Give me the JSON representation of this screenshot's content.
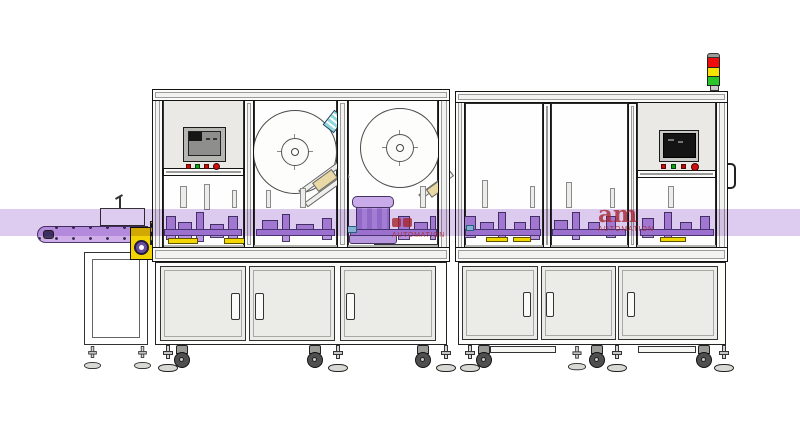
{
  "watermark": {
    "logo": "am",
    "caption": "AUTOMATION",
    "color": "#c03030"
  },
  "colors": {
    "highlight_band": "#decbf0",
    "conveyor_belt": "#cfaeea",
    "machine_part_purple": "#b995e0",
    "rail_purple": "#b28ddc",
    "accent_yellow": "#f2d403",
    "accent_cyan": "#9adde0",
    "tower_red": "#ef0d0b",
    "tower_yellow": "#f6e303",
    "tower_green": "#29c62a",
    "button_red": "#c40f0f",
    "button_green": "#14a014",
    "panel_gray": "#eae9e6",
    "door_gray": "#ebebe8",
    "frame_outline": "#141414",
    "screen_dark": "#141414",
    "screen_gray": "#8e8e8c",
    "tan_block": "#e9d9a5"
  },
  "signal_tower": {
    "segments": [
      "red",
      "yellow",
      "green"
    ]
  },
  "hmi_left": {
    "buttons": [
      "red",
      "green",
      "red",
      "red-round"
    ]
  },
  "hmi_right": {
    "buttons": [
      "red",
      "green",
      "red",
      "red-round"
    ]
  },
  "shapes": [
    {
      "n": "guard-post",
      "c": "post",
      "x": 180,
      "y": 186,
      "w": 7,
      "h": 22
    },
    {
      "n": "guard-post",
      "c": "post",
      "x": 204,
      "y": 184,
      "w": 6,
      "h": 26
    },
    {
      "n": "guard-post",
      "c": "post",
      "x": 232,
      "y": 190,
      "w": 5,
      "h": 18
    },
    {
      "n": "guard-post",
      "c": "post",
      "x": 266,
      "y": 190,
      "w": 5,
      "h": 18
    },
    {
      "n": "guard-post",
      "c": "post",
      "x": 300,
      "y": 188,
      "w": 6,
      "h": 20
    },
    {
      "n": "guard-post",
      "c": "post",
      "x": 420,
      "y": 186,
      "w": 6,
      "h": 22
    },
    {
      "n": "guard-post",
      "c": "post",
      "x": 482,
      "y": 180,
      "w": 6,
      "h": 28
    },
    {
      "n": "guard-post",
      "c": "post",
      "x": 530,
      "y": 186,
      "w": 5,
      "h": 22
    },
    {
      "n": "guard-post",
      "c": "post",
      "x": 566,
      "y": 182,
      "w": 6,
      "h": 26
    },
    {
      "n": "guard-post",
      "c": "post",
      "x": 610,
      "y": 188,
      "w": 5,
      "h": 20
    },
    {
      "n": "guard-post",
      "c": "post",
      "x": 668,
      "y": 186,
      "w": 6,
      "h": 22
    },
    {
      "n": "machine-part",
      "c": "part",
      "x": 166,
      "y": 216,
      "w": 10,
      "h": 24
    },
    {
      "n": "machine-part",
      "c": "part",
      "x": 178,
      "y": 222,
      "w": 14,
      "h": 18
    },
    {
      "n": "machine-part",
      "c": "part",
      "x": 196,
      "y": 212,
      "w": 8,
      "h": 30
    },
    {
      "n": "machine-part",
      "c": "part",
      "x": 210,
      "y": 224,
      "w": 14,
      "h": 14
    },
    {
      "n": "machine-part",
      "c": "part",
      "x": 228,
      "y": 216,
      "w": 10,
      "h": 26
    },
    {
      "n": "machine-part",
      "c": "part",
      "x": 262,
      "y": 220,
      "w": 16,
      "h": 16
    },
    {
      "n": "machine-part",
      "c": "part",
      "x": 282,
      "y": 214,
      "w": 8,
      "h": 28
    },
    {
      "n": "machine-part",
      "c": "part",
      "x": 296,
      "y": 224,
      "w": 18,
      "h": 12
    },
    {
      "n": "machine-part",
      "c": "part",
      "x": 322,
      "y": 218,
      "w": 10,
      "h": 22
    },
    {
      "n": "machine-part",
      "c": "part",
      "x": 398,
      "y": 216,
      "w": 12,
      "h": 24
    },
    {
      "n": "machine-part",
      "c": "part",
      "x": 414,
      "y": 222,
      "w": 14,
      "h": 14
    },
    {
      "n": "machine-part",
      "c": "part",
      "x": 430,
      "y": 216,
      "w": 6,
      "h": 24
    },
    {
      "n": "machine-part",
      "c": "part",
      "x": 464,
      "y": 216,
      "w": 12,
      "h": 22
    },
    {
      "n": "machine-part",
      "c": "part",
      "x": 480,
      "y": 222,
      "w": 14,
      "h": 14
    },
    {
      "n": "machine-part",
      "c": "part",
      "x": 498,
      "y": 212,
      "w": 8,
      "h": 28
    },
    {
      "n": "machine-part",
      "c": "part",
      "x": 514,
      "y": 222,
      "w": 12,
      "h": 14
    },
    {
      "n": "machine-part",
      "c": "part",
      "x": 530,
      "y": 216,
      "w": 10,
      "h": 24
    },
    {
      "n": "machine-part",
      "c": "part",
      "x": 554,
      "y": 220,
      "w": 14,
      "h": 16
    },
    {
      "n": "machine-part",
      "c": "part",
      "x": 572,
      "y": 212,
      "w": 8,
      "h": 28
    },
    {
      "n": "machine-part",
      "c": "part",
      "x": 588,
      "y": 222,
      "w": 12,
      "h": 14
    },
    {
      "n": "machine-part",
      "c": "part",
      "x": 606,
      "y": 216,
      "w": 10,
      "h": 22
    },
    {
      "n": "machine-part",
      "c": "part",
      "x": 642,
      "y": 218,
      "w": 12,
      "h": 20
    },
    {
      "n": "machine-part",
      "c": "part",
      "x": 664,
      "y": 212,
      "w": 8,
      "h": 28
    },
    {
      "n": "machine-part",
      "c": "part",
      "x": 680,
      "y": 222,
      "w": 12,
      "h": 14
    },
    {
      "n": "machine-part",
      "c": "part",
      "x": 700,
      "y": 216,
      "w": 10,
      "h": 20
    },
    {
      "n": "transfer-rail",
      "c": "rail",
      "x": 164,
      "y": 229,
      "w": 78,
      "h": 7
    },
    {
      "n": "transfer-rail",
      "c": "rail",
      "x": 256,
      "y": 229,
      "w": 79,
      "h": 7
    },
    {
      "n": "transfer-rail",
      "c": "rail",
      "x": 350,
      "y": 229,
      "w": 87,
      "h": 7
    },
    {
      "n": "transfer-rail",
      "c": "rail",
      "x": 465,
      "y": 229,
      "w": 76,
      "h": 7
    },
    {
      "n": "transfer-rail",
      "c": "rail",
      "x": 552,
      "y": 229,
      "w": 74,
      "h": 7
    },
    {
      "n": "transfer-rail",
      "c": "rail",
      "x": 640,
      "y": 229,
      "w": 74,
      "h": 7
    },
    {
      "n": "yellow-strip",
      "c": "ystrip",
      "x": 168,
      "y": 238,
      "w": 30,
      "h": 6
    },
    {
      "n": "yellow-strip",
      "c": "ystrip",
      "x": 224,
      "y": 238,
      "w": 24,
      "h": 6
    },
    {
      "n": "yellow-strip",
      "c": "ystrip",
      "x": 486,
      "y": 237,
      "w": 22,
      "h": 5
    },
    {
      "n": "yellow-strip",
      "c": "ystrip",
      "x": 513,
      "y": 237,
      "w": 18,
      "h": 5
    },
    {
      "n": "yellow-strip",
      "c": "ystrip",
      "x": 660,
      "y": 237,
      "w": 26,
      "h": 5
    },
    {
      "n": "cyan-fitting",
      "c": "cyan",
      "x": 347,
      "y": 226,
      "w": 10,
      "h": 7
    },
    {
      "n": "cyan-fitting",
      "c": "cyan",
      "x": 466,
      "y": 225,
      "w": 8,
      "h": 6
    },
    {
      "n": "bench-edge",
      "c": "gline",
      "x": 164,
      "y": 245,
      "w": 274,
      "h": 3
    },
    {
      "n": "bench-edge",
      "c": "gline",
      "x": 465,
      "y": 245,
      "w": 252,
      "h": 3
    },
    {
      "n": "base-crossbar",
      "c": "bar",
      "x": 490,
      "y": 346,
      "w": 66,
      "h": 7
    },
    {
      "n": "base-crossbar",
      "c": "bar",
      "x": 638,
      "y": 346,
      "w": 58,
      "h": 7
    },
    {
      "n": "door-interlock",
      "c": "ylock",
      "x": 150,
      "y": 221,
      "w": 9,
      "h": 24
    }
  ],
  "feet": [
    {
      "x": 158,
      "y": 345
    },
    {
      "x": 328,
      "y": 345
    },
    {
      "x": 436,
      "y": 345
    },
    {
      "x": 460,
      "y": 345
    },
    {
      "x": 568,
      "y": 346,
      "s": 0.9
    },
    {
      "x": 607,
      "y": 345
    },
    {
      "x": 714,
      "y": 345
    },
    {
      "x": 84,
      "y": 346,
      "s": 0.85
    },
    {
      "x": 134,
      "y": 346,
      "s": 0.85
    }
  ],
  "casters": [
    {
      "x": 173,
      "y": 345
    },
    {
      "x": 306,
      "y": 345
    },
    {
      "x": 414,
      "y": 345
    },
    {
      "x": 475,
      "y": 345
    },
    {
      "x": 588,
      "y": 345
    },
    {
      "x": 695,
      "y": 345
    }
  ]
}
